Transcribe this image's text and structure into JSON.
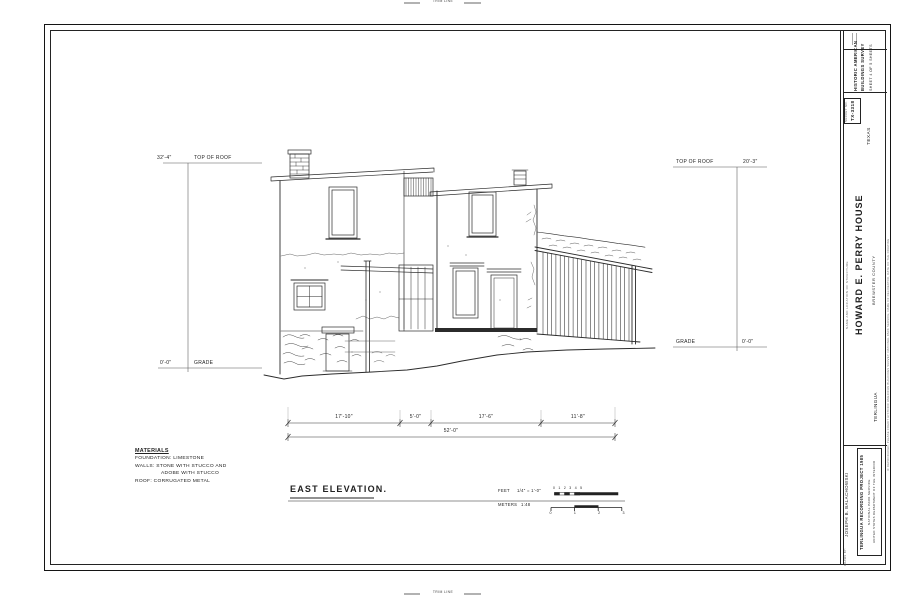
{
  "trim": {
    "top": "TRIM LINE",
    "bottom": "TRIM LINE"
  },
  "title_block": {
    "survey_line1": "HISTORIC AMERICAN",
    "survey_line2": "BUILDINGS SURVEY",
    "sheet_info": "SHEET 4 OF 5 SHEETS",
    "survey_no_label": "SURVEY NO.",
    "survey_no": "TX-3318",
    "state": "TEXAS",
    "name_label": "NAME AND LOCATION OF STRUCTURE",
    "structure_name": "HOWARD E. PERRY HOUSE",
    "county": "BREWSTER COUNTY",
    "town": "TERLINGUA",
    "credit": "IF REPRODUCED, PLEASE CREDIT HISTORIC AMERICAN BUILDINGS SURVEY, NATIONAL PARK SERVICE, NAME OF DELINEATOR, DATE OF THE DRAWING",
    "drawn_by_label": "DRAWN BY:",
    "delineator": "JOSEPH B. BALACHOWSKI",
    "project": "TERLINGUA RECORDING PROJECT 1985",
    "agency": "NATIONAL PARK SERVICE",
    "department": "UNITED STATES DEPARTMENT OF THE INTERIOR"
  },
  "drawing": {
    "title": "EAST ELEVATION.",
    "marks": {
      "left_top_value": "32'-4\"",
      "left_top_label": "TOP OF ROOF",
      "left_bottom_value": "0'-0\"",
      "left_bottom_label": "GRADE",
      "right_top_label": "TOP OF ROOF",
      "right_top_value": "20'-3\"",
      "right_bottom_label": "GRADE",
      "right_bottom_value": "0'-0\""
    },
    "dimensions": {
      "segments": [
        "17'-10\"",
        "5'-0\"",
        "17'-6\"",
        "11'-8\""
      ],
      "total": "52'-0\""
    },
    "materials": {
      "heading": "MATERIALS",
      "line1": "FOUNDATION: LIMESTONE",
      "line2": "WALLS: STONE WITH STUCCO AND",
      "line3": "ADOBE WITH STUCCO",
      "line4": "ROOF: CORRUGATED METAL"
    },
    "scale": {
      "feet_label": "FEET",
      "feet_ratio": "1/4\" = 1'-0\"",
      "meters_label": "METERS",
      "meters_ratio": "1:48",
      "feet_ticks": [
        "0",
        "1",
        "2",
        "3",
        "4",
        "5"
      ],
      "meter_ticks": [
        "0",
        "1",
        "2",
        "3"
      ]
    }
  }
}
